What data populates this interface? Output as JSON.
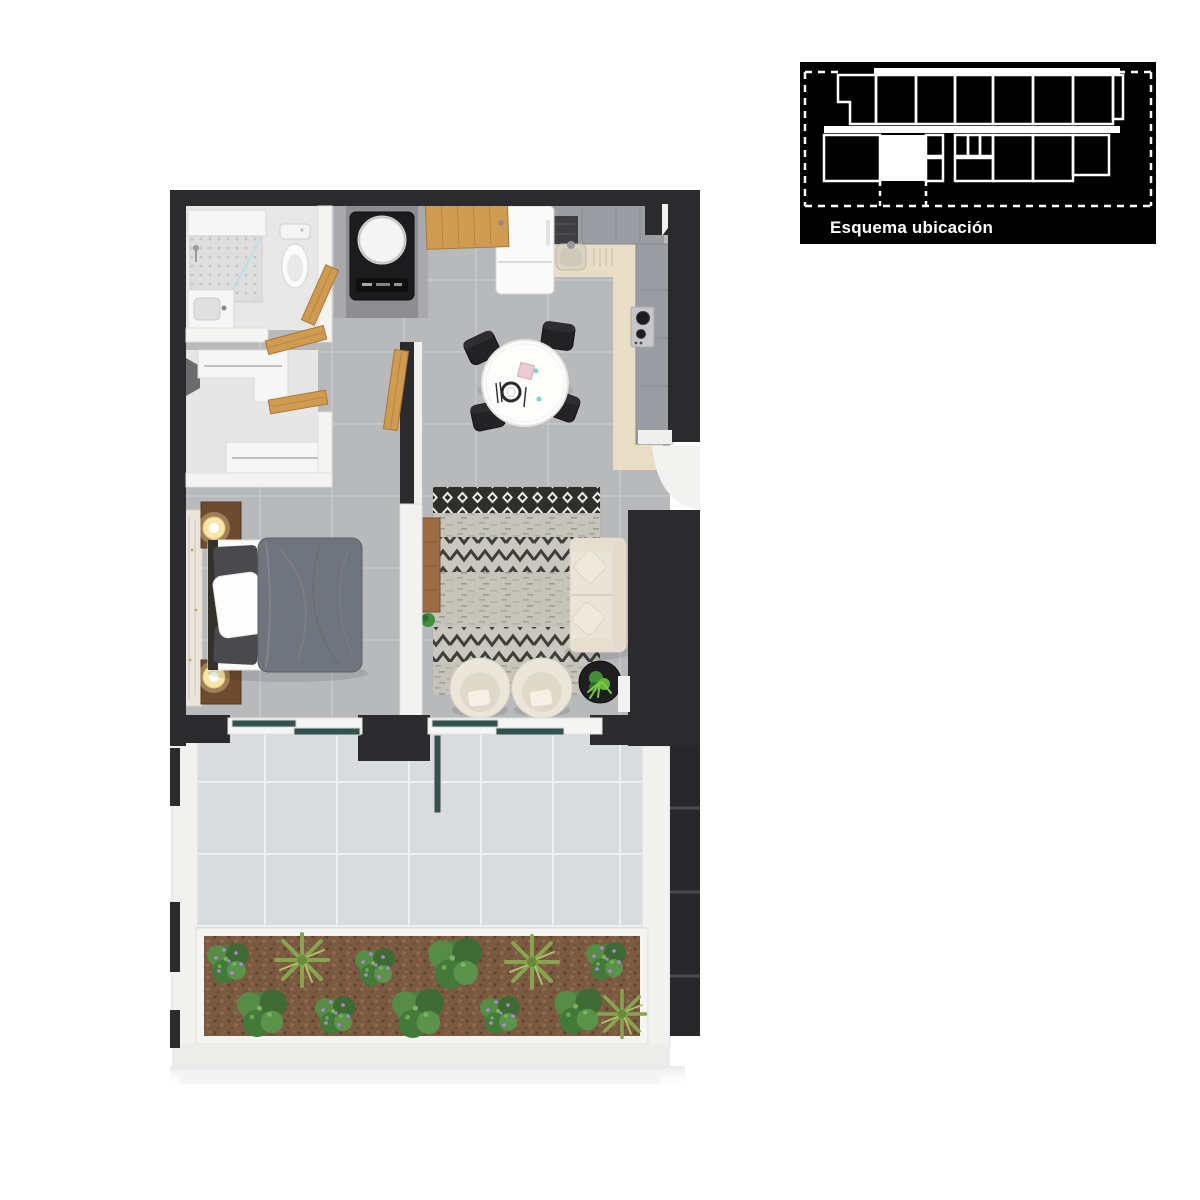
{
  "inset": {
    "label": "Esquema ubicación",
    "bg": "#000000",
    "line_color": "#ffffff",
    "highlight_color": "#ffffff"
  },
  "palette": {
    "wall_dark": "#2b2b2e",
    "floor_tile": "#b7b9bb",
    "floor_grout": "#cdcfd1",
    "terrace_tile": "#d9dcde",
    "terrace_grout": "#eef0f2",
    "kitchen_counter": "#e9dec5",
    "cabinet_gray": "#9a9ea3",
    "wood": "#cf9a52",
    "wood_dark": "#6e4b2f",
    "white_wall": "#f2f2f1",
    "appliance_black": "#1c1c1f",
    "sofa_cream": "#eae4d8",
    "bed_gray": "#70747c",
    "rug_base": "#cac7be",
    "rug_dark": "#3e3e3c",
    "plant_green": "#4c8040",
    "plant_palm": "#87a54e",
    "flower_purple": "#b184d6",
    "soil_brown": "#7b5a41",
    "glass_teal": "#33514e",
    "marble_panel": "#e9e5dc"
  }
}
